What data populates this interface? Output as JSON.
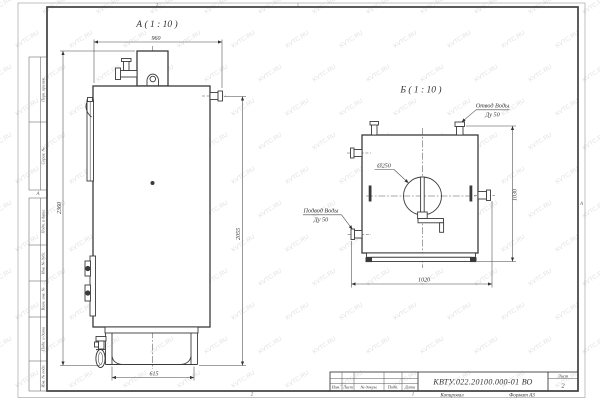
{
  "watermark": {
    "text": "KVTC.RU"
  },
  "sheet": {
    "zone_top_left": "2",
    "zone_bottom_left": "2",
    "zone_bottom_right": "1",
    "zone_letter_left": "А",
    "zone_letter_right": "А",
    "footer": {
      "copy": "Копировал",
      "format": "Формат А3"
    },
    "margin_boxes": [
      "Перв. примен.",
      "Справ. №",
      "Подп. и дата",
      "Инв. № дубл.",
      "Взам. инв. №",
      "Подп. и дата",
      "Инв. № подл."
    ]
  },
  "title_block": {
    "doc_number": "КВТУ.022.20100.000-01 ВО",
    "sheet_label": "Лист",
    "sheet_number": "2",
    "columns": [
      "Изм.",
      "Лист",
      "№ докум.",
      "Подп.",
      "Дата"
    ]
  },
  "view_a": {
    "label": "А ( 1 : 10 )",
    "dim_width": "960",
    "dim_height_overall": "2360",
    "dim_height_body": "2055",
    "dim_base": "615"
  },
  "view_b": {
    "label": "Б ( 1 : 10 )",
    "dim_height": "1030",
    "dim_width": "1020",
    "diameter_label": "Ø250",
    "outlet": {
      "line1": "Отвод Воды",
      "line2": "Ду 50"
    },
    "inlet": {
      "line1": "Подвод Воды",
      "line2": "Ду 50"
    }
  }
}
